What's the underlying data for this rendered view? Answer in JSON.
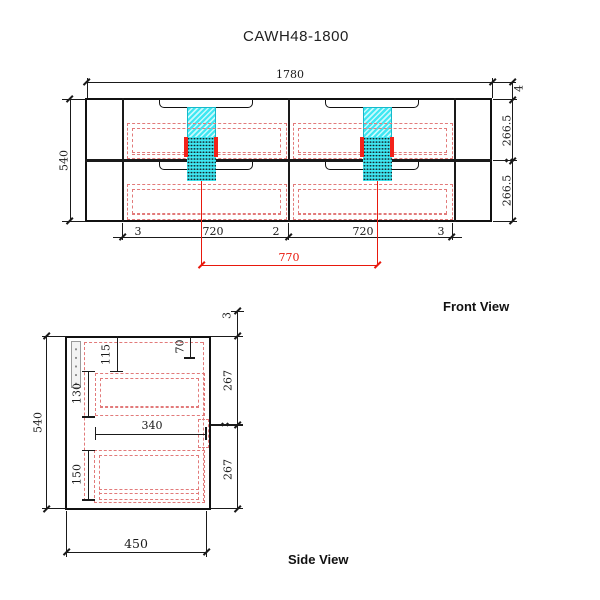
{
  "title": "CAWH48-1800",
  "front": {
    "label": "Front View",
    "dim_width": "1780",
    "dim_height": "540",
    "dim_top": "4",
    "dim_row1": "266.5",
    "dim_row2": "266.5",
    "dim_b1": "3",
    "dim_b2": "720",
    "dim_b3": "2",
    "dim_b4": "720",
    "dim_b5": "3",
    "dim_centers": "770"
  },
  "side": {
    "label": "Side View",
    "dim_height": "540",
    "dim_depth": "450",
    "dim_top": "3",
    "dim_70": "70",
    "dim_115": "115",
    "dim_130": "130",
    "dim_150": "150",
    "dim_340": "340",
    "dim_267a": "267",
    "dim_267b": "267"
  },
  "colors": {
    "line": "#1a1a1a",
    "dimension_red": "#e8180c",
    "construction_salmon": "#e27a7a",
    "basin_cyan": "#3ee7f2"
  }
}
